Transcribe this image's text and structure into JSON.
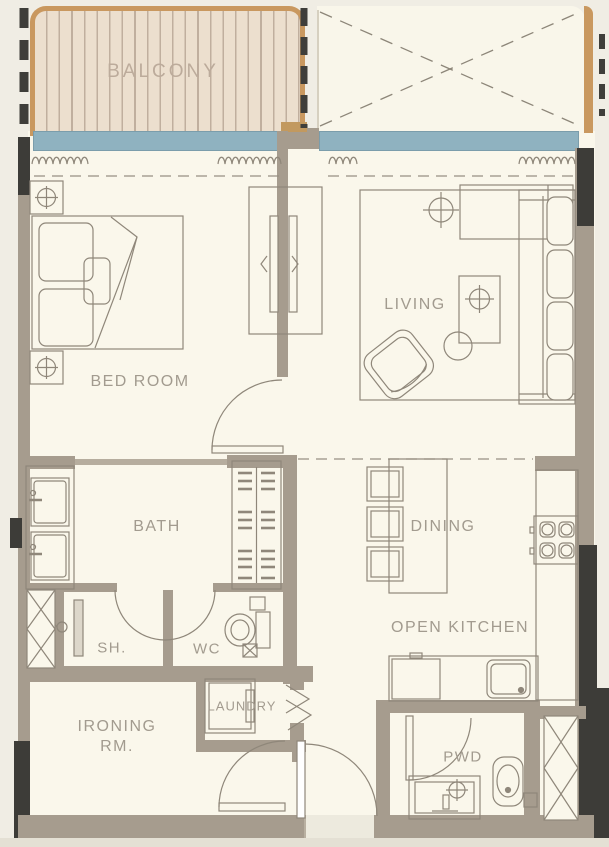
{
  "plan": {
    "labels": {
      "balcony": "BALCONY",
      "bedroom": "BED ROOM",
      "living": "LIVING",
      "bath": "BATH",
      "dining": "DINING",
      "open_kitchen": "OPEN KITCHEN",
      "shower": "SH.",
      "wc": "WC",
      "ironing_line1": "IRONING",
      "ironing_line2": "RM.",
      "laundry": "LAUNDRY",
      "powder": "PWD"
    },
    "colors": {
      "wall": "#a69c8e",
      "wall_dark": "#3d3c38",
      "floor": "#faf7eb",
      "balcony_deck": "#ecdfce",
      "balcony_border": "#c9985f",
      "window_glass": "#8fb2c0",
      "furniture_line": "#8f877a",
      "label_text": "#a29b8f"
    }
  }
}
